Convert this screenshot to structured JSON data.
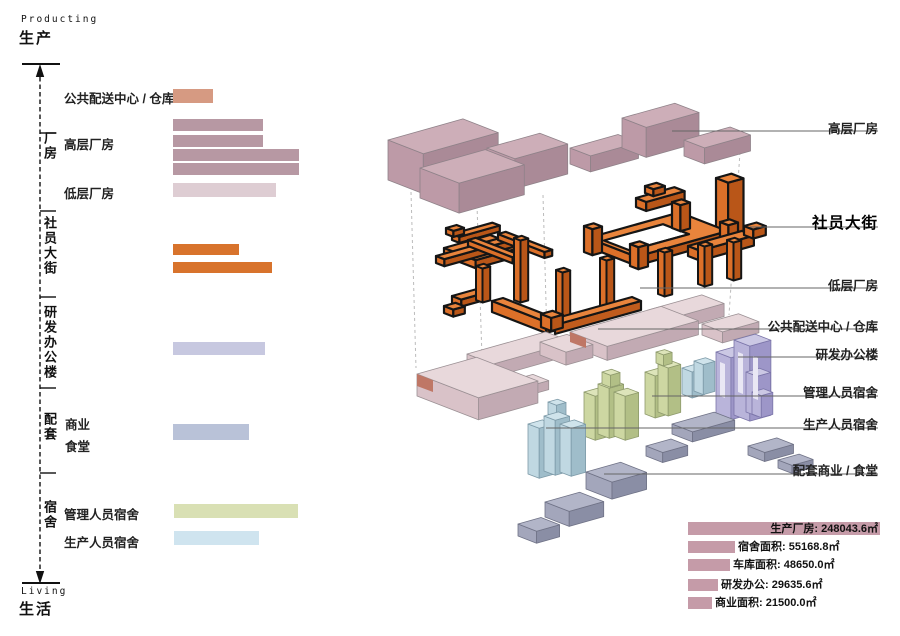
{
  "page": {
    "title_top_en": "Producting",
    "title_top_zh": "生产",
    "title_bottom_en": "Living",
    "title_bottom_zh": "生活"
  },
  "left_panel": {
    "group_labels": [
      "厂房",
      "社员大街",
      "研发办公楼",
      "配套",
      "宿舍"
    ],
    "row_labels": {
      "distribution": "公共配送中心 / 仓库",
      "highrise": "高层厂房",
      "lowrise": "低层厂房",
      "business": "商业",
      "canteen": "食堂",
      "manager_dorm": "管理人员宿舍",
      "worker_dorm": "生产人员宿舍"
    }
  },
  "callouts": {
    "labels": [
      "高层厂房",
      "社员大街",
      "低层厂房",
      "公共配送中心 / 仓库",
      "研发办公楼",
      "管理人员宿舍",
      "生产人员宿舍",
      "配套商业 / 食堂"
    ]
  },
  "stats": [
    {
      "label": "生产厂房",
      "value": 248043.6,
      "text": "生产厂房: 248043.6㎡"
    },
    {
      "label": "宿舍面积",
      "value": 55168.8,
      "text": "宿舍面积: 55168.8㎡"
    },
    {
      "label": "车库面积",
      "value": 48650.0,
      "text": "车库面积: 48650.0㎡"
    },
    {
      "label": "研发办公",
      "value": 29635.6,
      "text": "研发办公: 29635.6㎡"
    },
    {
      "label": "商业面积",
      "value": 21500.0,
      "text": "商业面积: 21500.0㎡"
    }
  ],
  "chart_data": [
    {
      "type": "bar",
      "title": "program bars (left legend, relative lengths, no numeric axis)",
      "categories": [
        "公共配送中心 / 仓库",
        "高层厂房",
        "高层厂房",
        "高层厂房",
        "高层厂房",
        "低层厂房",
        "社员大街",
        "社员大街",
        "研发办公楼",
        "配套商业/食堂",
        "管理人员宿舍",
        "生产人员宿舍"
      ],
      "values": [
        40,
        90,
        90,
        126,
        126,
        103,
        66,
        99,
        92,
        76,
        124,
        85
      ],
      "colors": [
        "#d69a82",
        "#b798a3",
        "#b798a3",
        "#b798a3",
        "#b798a3",
        "#decdd3",
        "#d8732c",
        "#d8732c",
        "#c7c8e0",
        "#b9c2d8",
        "#d9e0b4",
        "#cfe4ef"
      ],
      "xlabel": "",
      "ylabel": "",
      "legend_position": "none"
    },
    {
      "type": "bar",
      "title": "面积统计 (bottom-right)",
      "categories": [
        "生产厂房",
        "宿舍面积",
        "车库面积",
        "研发办公",
        "商业面积"
      ],
      "values": [
        248043.6,
        55168.8,
        48650.0,
        29635.6,
        21500.0
      ],
      "unit": "㎡",
      "bar_color": "#c59ba8",
      "legend_position": "none"
    }
  ],
  "colors": {
    "salmon_bar": "#d69a82",
    "mauve_bar": "#b798a3",
    "lightpink_bar": "#decdd3",
    "orange_bar": "#d8732c",
    "lavender_bar": "#c7c8e0",
    "bluegray_bar": "#b9c2d8",
    "green_bar": "#d9e0b4",
    "lightblue_bar": "#cfe4ef",
    "stat_bar": "#c59ba8",
    "street_orange": "#e9843c",
    "highrise_mauve": "#cdaeb8",
    "slab_pink": "#e8d8db"
  }
}
